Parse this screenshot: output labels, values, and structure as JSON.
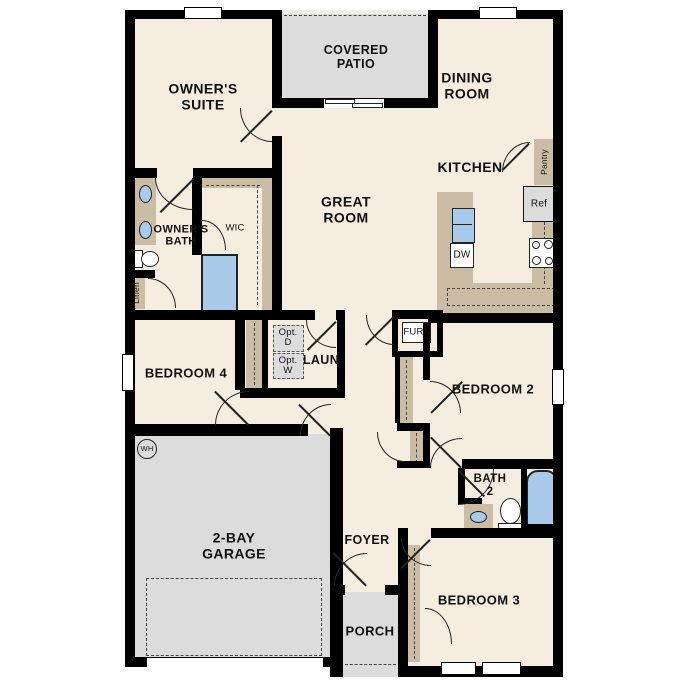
{
  "title": "Single-story floor plan",
  "colors": {
    "wall": "#000000",
    "floor": "#f5eee0",
    "outdoor": "#dcdcdc",
    "casework": "#cbbda3",
    "fixture": "#a9cae8",
    "ink": "#111111"
  },
  "rooms": {
    "covered_patio": "COVERED\nPATIO",
    "owners_suite": "OWNER'S\nSUITE",
    "dining_room": "DINING\nROOM",
    "great_room": "GREAT\nROOM",
    "kitchen": "KITCHEN",
    "owners_bath": "OWNER'S\nBATH",
    "wic": "WIC",
    "laundry": "LAUN",
    "bedroom4": "BEDROOM 4",
    "bedroom2": "BEDROOM 2",
    "bedroom3": "BEDROOM 3",
    "bath2": "BATH\n2",
    "foyer": "FOYER",
    "porch": "PORCH",
    "garage": "2-BAY\nGARAGE"
  },
  "fixtures": {
    "pantry": "Pantry",
    "refrigerator": "Ref",
    "dishwasher": "DW",
    "furnace": "FURN",
    "linen": "Linen",
    "water_heater": "WH",
    "opt_dryer": "Opt.\nD",
    "opt_washer": "Opt.\nW"
  }
}
